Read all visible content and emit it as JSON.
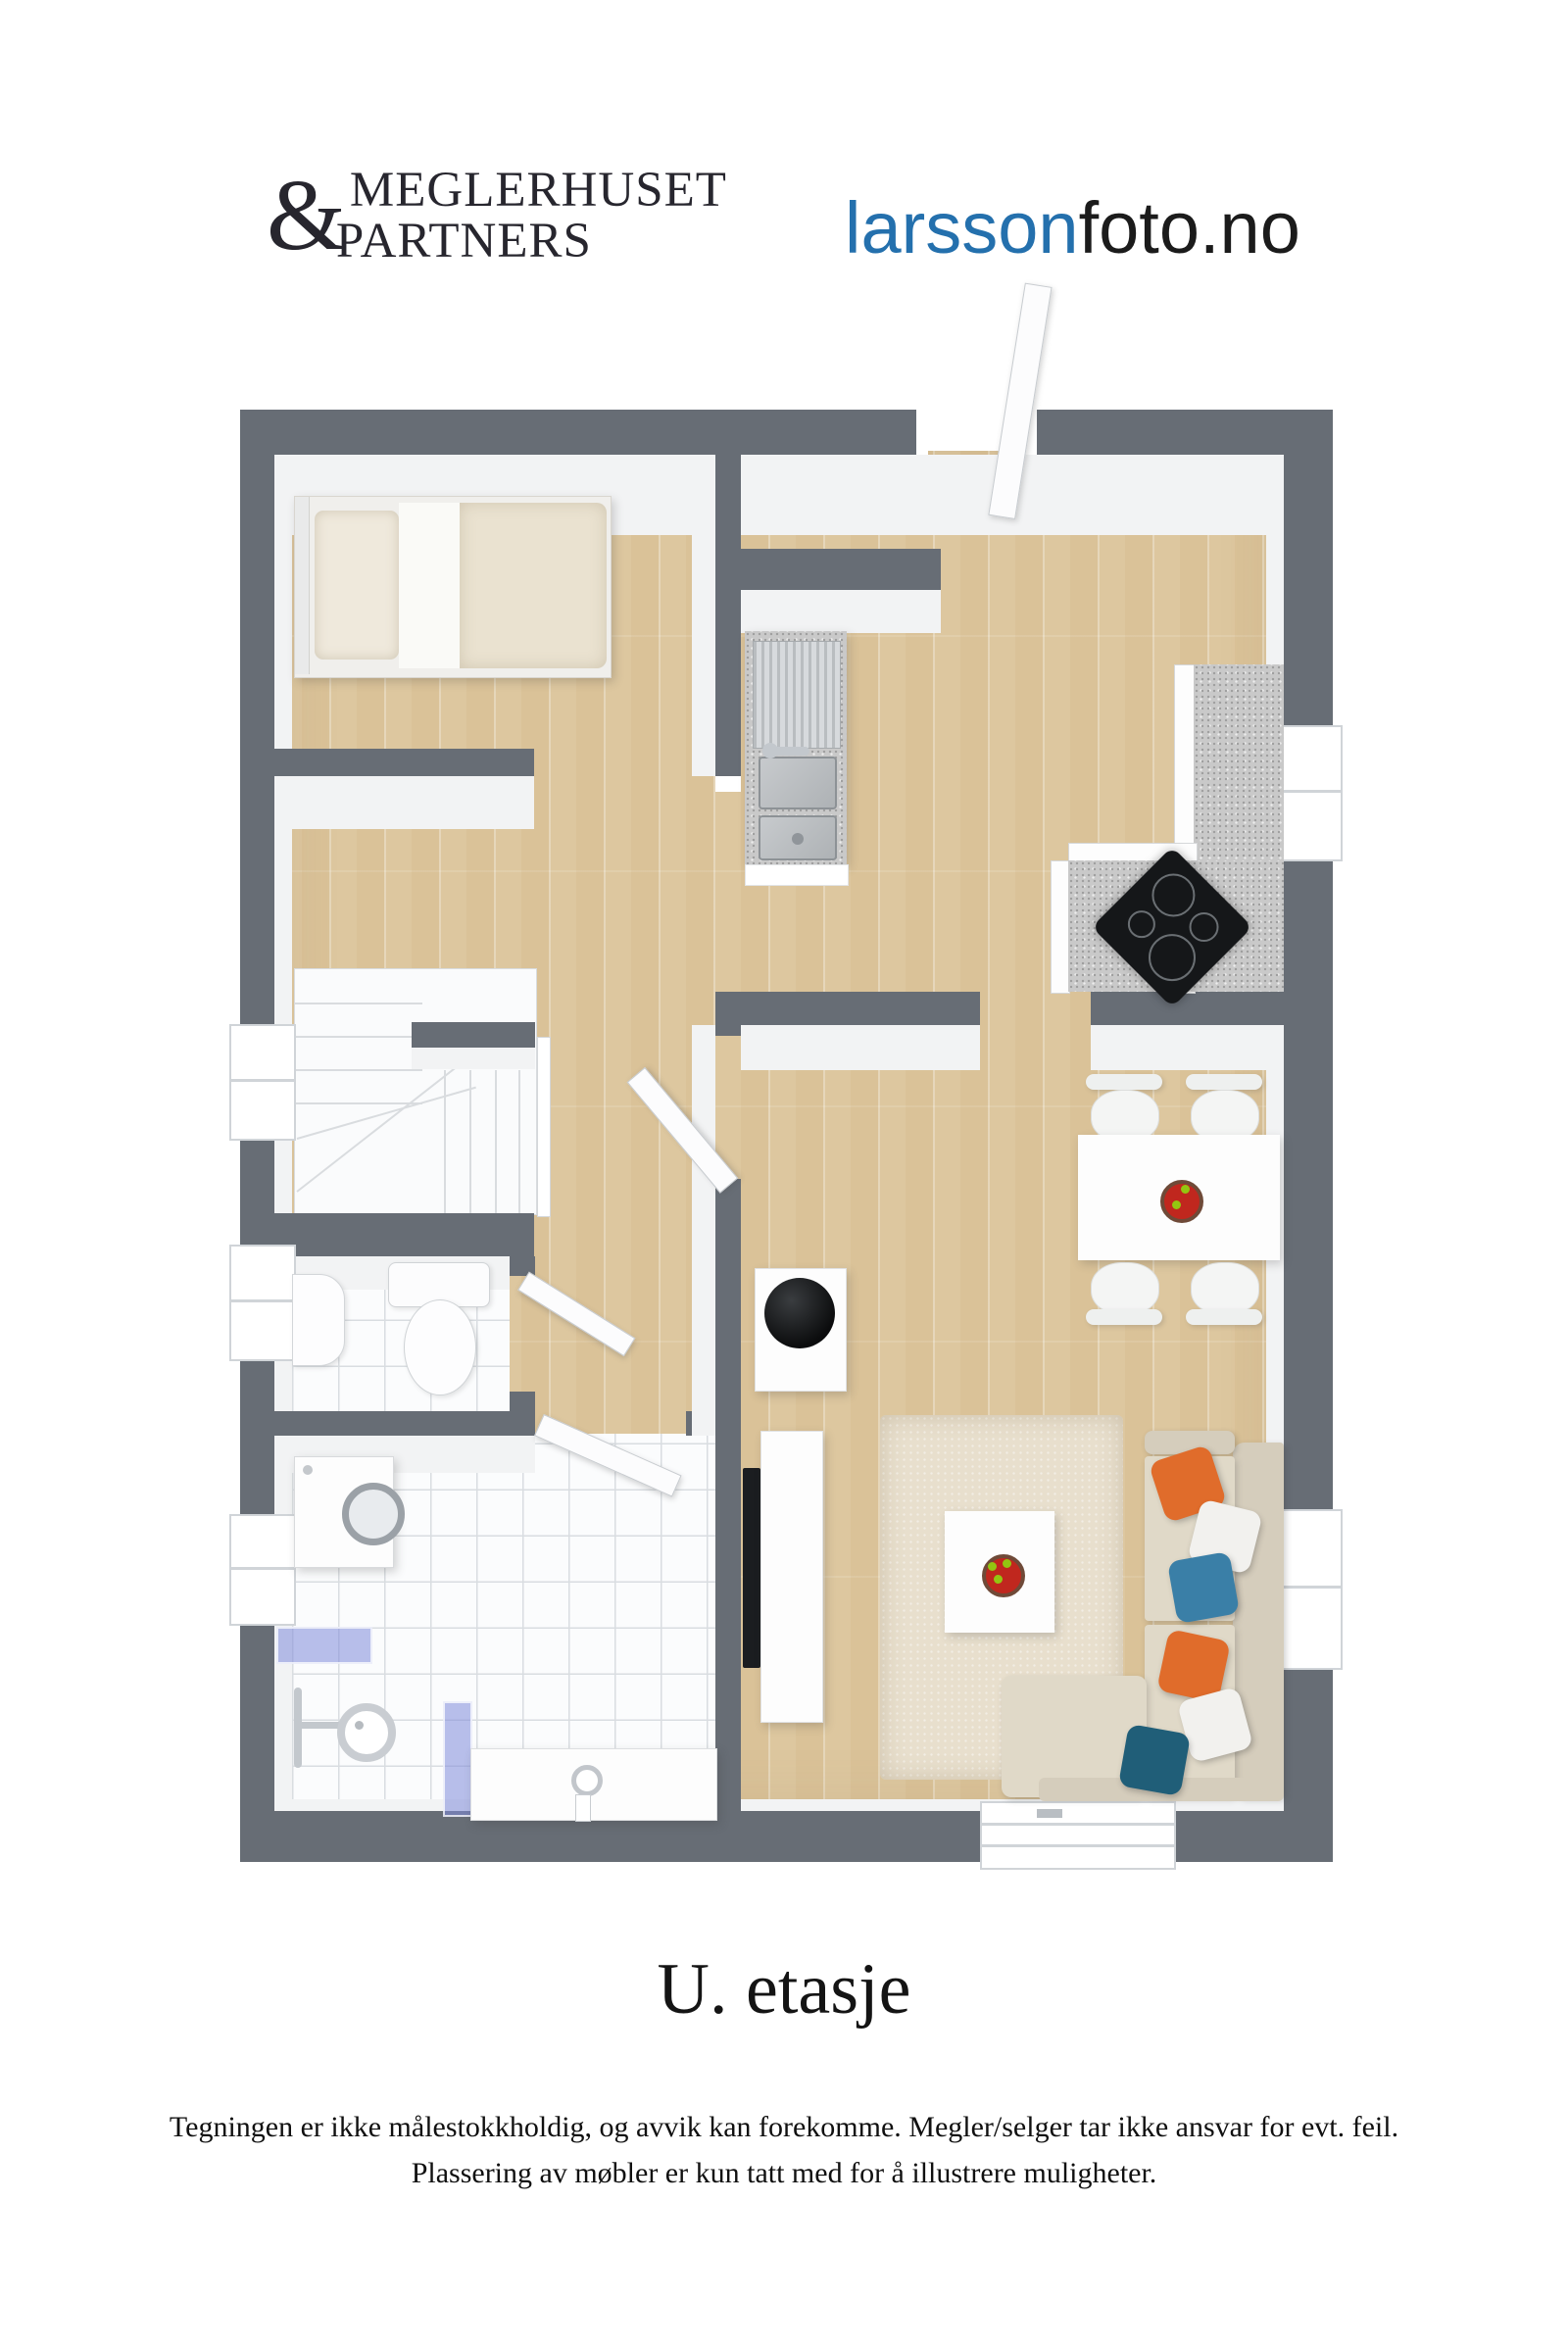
{
  "brand": {
    "ampersand": "&",
    "name_top": "MEGLERHUSET",
    "name_bottom": "PARTNERS"
  },
  "photo_credit": {
    "prefix": "larsson",
    "suffix": "foto.no"
  },
  "floor_label": {
    "title": "U. etasje"
  },
  "disclaimer": {
    "line1": "Tegningen er ikke målestokkholdig, og avvik kan forekomme. Megler/selger tar ikke ansvar for evt. feil.",
    "line2": "Plassering av møbler er kun tatt med for å illustrere muligheter."
  },
  "colors": {
    "wall": "#676d75",
    "wallface": "#f2f3f4",
    "wood": "#ddc79f",
    "tile": "#fbfcfd",
    "tileline": "#d9dde1",
    "granite": "#c9c9c9",
    "glass": "rgba(128,138,218,0.55)",
    "orange": "#e06c2b",
    "teal": "#3a7fa7",
    "darkteal": "#205e78",
    "duvet": "#eae2d0",
    "pillowbed": "#efe9dc",
    "rug": "#e8dfcd",
    "sofa": "#e0d9c8",
    "sofadark": "#d5cdbc",
    "furniturewhite": "#fdfdfd",
    "black": "#17181a",
    "brand": "#27262e",
    "blue": "#2470ad"
  }
}
